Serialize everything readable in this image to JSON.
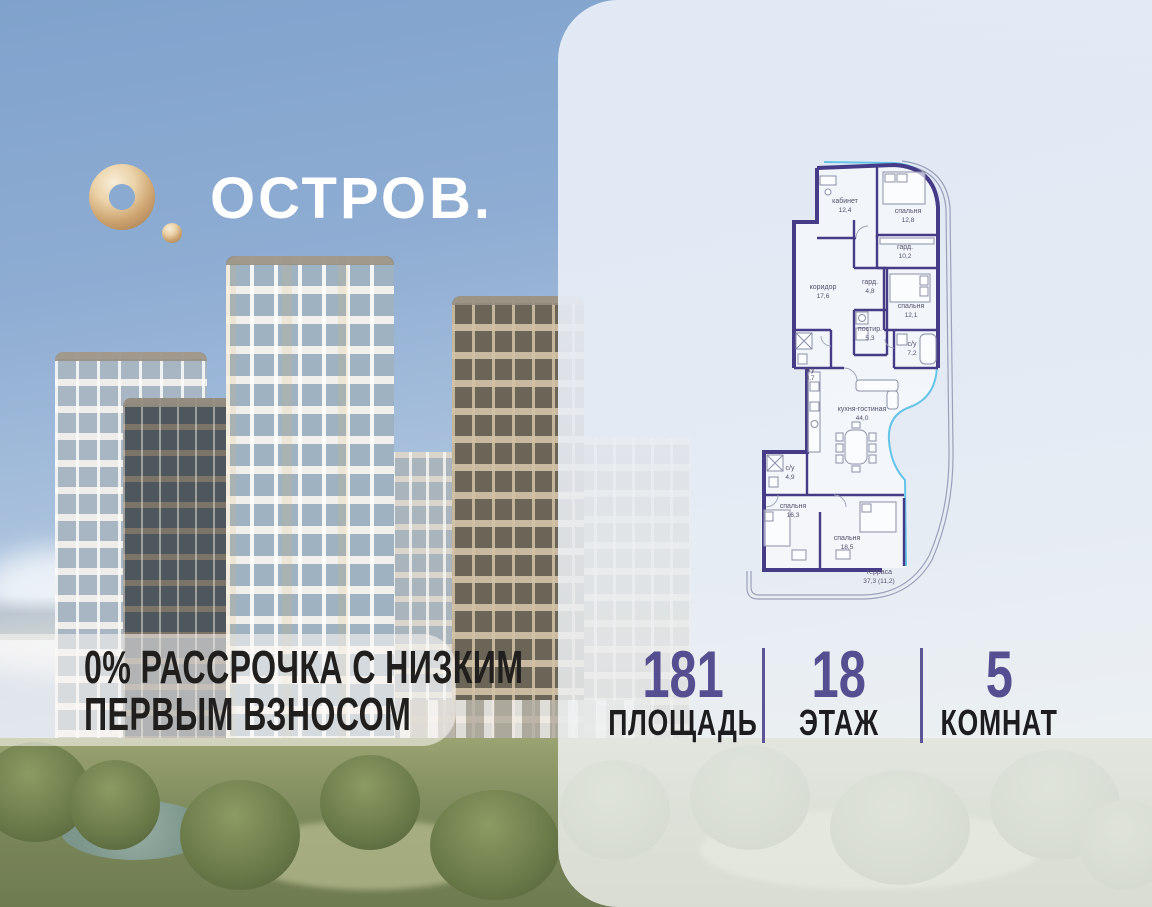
{
  "brand": {
    "wordmark": "ОСТРОВ.",
    "mark_color": "#d8b586"
  },
  "promo": {
    "line1": "0% РАССРОЧКА С НИЗКИМ",
    "line2": "ПЕРВЫМ ВЗНОСОМ"
  },
  "stats": {
    "items": [
      {
        "value": "181",
        "label": "ПЛОЩАДЬ"
      },
      {
        "value": "18",
        "label": "ЭТАЖ"
      },
      {
        "value": "5",
        "label": "КОМНАТ"
      }
    ]
  },
  "floorplan": {
    "rooms": [
      {
        "name": "кабинет",
        "area": "12,4"
      },
      {
        "name": "спальня",
        "area": "12,8"
      },
      {
        "name": "гард.",
        "area": "10,2"
      },
      {
        "name": "коридор",
        "area": "17,6"
      },
      {
        "name": "гард.",
        "area": "4,8"
      },
      {
        "name": "спальня",
        "area": "12,1"
      },
      {
        "name": "постир.",
        "area": "5,3"
      },
      {
        "name": "с/у",
        "area": "3,7"
      },
      {
        "name": "с/у",
        "area": "7,2"
      },
      {
        "name": "кухня-гостиная",
        "area": "44,0"
      },
      {
        "name": "с/у",
        "area": "4,9"
      },
      {
        "name": "спальня",
        "area": "16,3"
      },
      {
        "name": "спальня",
        "area": "18,5"
      },
      {
        "name": "терраса",
        "area": "37,3 (11,2)"
      }
    ]
  },
  "colors": {
    "accent_purple": "#554e90",
    "plan_wall": "#463b87",
    "glass_blue": "#5ec1e6",
    "brand_gold": "#d8b586",
    "sky_top": "#7fa2cc",
    "panel": "#e9eef6"
  }
}
